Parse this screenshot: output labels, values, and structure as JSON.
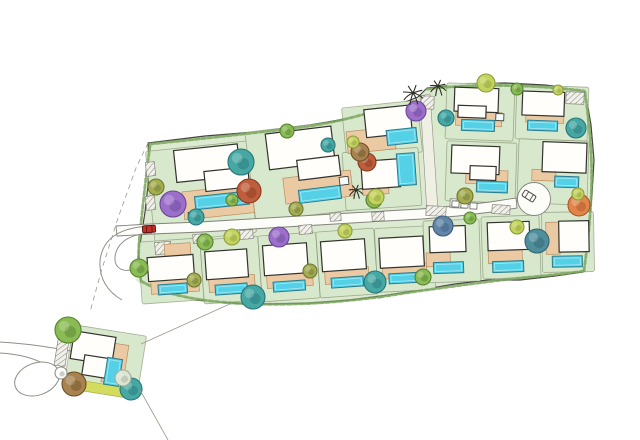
{
  "document": {
    "kind": "hand-drawn watercolor residential site masterplan",
    "canvas": {
      "width": 640,
      "height": 440
    },
    "visible_text": []
  },
  "palette": {
    "ink": "#45453c",
    "lawn": "#dcead2",
    "lawn_edge": "rgba(100,110,75,0.5)",
    "road_fill": "#fcfcf9",
    "road_stroke": "#82827a",
    "hedge": "#7aa55e",
    "hatch_line": "#8b8b81",
    "roles": {
      "house": {
        "f": "#fffefb",
        "s": "#33332d",
        "w": 1.2
      },
      "terrace": {
        "f": "#ebc9a3",
        "s": "#b98e60",
        "w": 0.7
      },
      "pool": {
        "f": "#55d1e7",
        "s": "#2a7d8e",
        "w": 1
      },
      "spa": {
        "f": "#f4fbfd",
        "s": "#33332d",
        "w": 0.8
      },
      "strip": {
        "f": "#d3dc5f",
        "s": "#a8b23c",
        "w": 0.6
      }
    },
    "trees": {
      "apple": {
        "f": "#8abb54",
        "s": "#55832f"
      },
      "lime": {
        "f": "#c3d35f",
        "s": "#8d9c39"
      },
      "teal": {
        "f": "#47a8a3",
        "s": "#26767c"
      },
      "slate": {
        "f": "#4f8e9b",
        "s": "#2f6470"
      },
      "slateblue": {
        "f": "#6286a8",
        "s": "#3d5f80"
      },
      "purple": {
        "f": "#9c6fca",
        "s": "#6c4899"
      },
      "brick": {
        "f": "#bf5e3d",
        "s": "#86391f"
      },
      "orange": {
        "f": "#e28449",
        "s": "#a85526"
      },
      "olive": {
        "f": "#a5ad52",
        "s": "#6f7630"
      },
      "olivebrown": {
        "f": "#a8834f",
        "s": "#6d5026"
      },
      "pale": {
        "f": "#dce4d4",
        "s": "#9fae94"
      },
      "whiteo": {
        "f": "#ffffff",
        "s": "#8f8f85"
      }
    }
  },
  "site": {
    "cluster_outline": [
      [
        148,
        143
      ],
      [
        205,
        136
      ],
      [
        255,
        132
      ],
      [
        310,
        125
      ],
      [
        345,
        119
      ],
      [
        372,
        111
      ],
      [
        400,
        104
      ],
      [
        418,
        97
      ],
      [
        427,
        88
      ],
      [
        465,
        84
      ],
      [
        505,
        83
      ],
      [
        545,
        85
      ],
      [
        585,
        90
      ],
      [
        591,
        125
      ],
      [
        594,
        160
      ],
      [
        592,
        195
      ],
      [
        589,
        225
      ],
      [
        585,
        255
      ],
      [
        583,
        272
      ],
      [
        555,
        276
      ],
      [
        520,
        280
      ],
      [
        488,
        280
      ],
      [
        455,
        284
      ],
      [
        420,
        290
      ],
      [
        388,
        295
      ],
      [
        350,
        300
      ],
      [
        310,
        303
      ],
      [
        270,
        304
      ],
      [
        230,
        303
      ],
      [
        195,
        300
      ],
      [
        163,
        292
      ],
      [
        141,
        281
      ],
      [
        138,
        258
      ],
      [
        141,
        238
      ],
      [
        145,
        212
      ],
      [
        148,
        185
      ],
      [
        149,
        163
      ]
    ],
    "lawn_patches": [
      [
        200,
        195,
        48,
        30,
        "#cde3bd",
        0
      ],
      [
        300,
        190,
        45,
        28,
        "#d3e7c4",
        0
      ],
      [
        480,
        112,
        62,
        30,
        "#d6e9c8",
        0
      ],
      [
        505,
        170,
        55,
        30,
        "#d0e5c2",
        0
      ],
      [
        300,
        272,
        165,
        26,
        "#d2e6c3",
        -2
      ],
      [
        120,
        365,
        18,
        26,
        "#cfe3b8",
        9
      ]
    ],
    "hedges": [
      "M150,144 C200,139 255,133 310,126 C335,122 355,117 372,112",
      "M150,146 C146,175 143,205 140,232 C138,252 138,268 141,280",
      "M141,281 C165,295 200,302 250,304 C300,305 330,303 380,297",
      "M380,297 C430,289 470,284 510,279 C540,276 565,274 584,271",
      "M585,92 C590,130 593,160 591,200 C589,235 586,255 584,271",
      "M427,89 C470,84 530,84 584,91",
      "M160,232 C200,228 240,224 300,221"
    ],
    "roads": {
      "main": "M116,226 L150,224 L200,222 L250,219 L300,216 L350,213 L385,211 L420,209 L455,206 L490,202 L516,198 L517,208 L492,212 L458,216 L422,219 L386,221 L352,223 L302,226 L252,229 L202,232 L152,234 L117,236 Z",
      "entrance": "M420,96 L430,94 L438,210 L427,213 Z",
      "culdesac": {
        "cx": 534,
        "cy": 199,
        "r": 16.5
      },
      "sw_access": [
        "M152,226 C116,227 102,241 100,261 C99,279 108,292 122,300",
        "M152,233 C125,234 116,246 115,257 C114,268 123,273 134,269"
      ],
      "west_road": [
        "M0,342 C35,344 76,351 114,361",
        "M0,353 C18,354 34,358 46,365"
      ],
      "west_bulb": {
        "cx": 37,
        "cy": 379,
        "rx": 23,
        "ry": 16,
        "rot": -20
      }
    },
    "lots": [
      {
        "id": "top-1",
        "rot": -6,
        "lawn": [
          150,
          146,
          102,
          92
        ],
        "parts": [
          [
            "house",
            178,
            148,
            64,
            32
          ],
          [
            "house",
            206,
            172,
            44,
            20
          ],
          [
            "terrace",
            182,
            190,
            70,
            28
          ],
          [
            "pool",
            194,
            196,
            54,
            13
          ],
          [
            "spa",
            186,
            211,
            11,
            8
          ]
        ]
      },
      {
        "id": "top-2",
        "rot": -7,
        "lawn": [
          250,
          126,
          102,
          90
        ],
        "parts": [
          [
            "house",
            270,
            130,
            66,
            36
          ],
          [
            "house",
            298,
            160,
            42,
            20
          ],
          [
            "terrace",
            282,
            176,
            68,
            26
          ],
          [
            "pool",
            296,
            190,
            42,
            13
          ],
          [
            "spa",
            338,
            182,
            9,
            8
          ]
        ]
      },
      {
        "id": "mid-upper",
        "rot": -6,
        "lawn": [
          344,
          104,
          76,
          52
        ],
        "parts": [
          [
            "house",
            366,
            108,
            46,
            28
          ],
          [
            "terrace",
            346,
            128,
            48,
            22
          ],
          [
            "pool",
            386,
            131,
            30,
            15
          ]
        ]
      },
      {
        "id": "mid-lower",
        "rot": -4,
        "lawn": [
          344,
          150,
          76,
          58
        ],
        "parts": [
          [
            "house",
            362,
            160,
            38,
            28
          ],
          [
            "pool",
            398,
            155,
            18,
            32
          ],
          [
            "terrace",
            362,
            184,
            26,
            10
          ]
        ]
      },
      {
        "id": "ne-row1-a",
        "rot": 2,
        "lawn": [
          446,
          84,
          68,
          56
        ],
        "parts": [
          [
            "house",
            454,
            88,
            44,
            24
          ],
          [
            "house",
            458,
            106,
            28,
            12
          ],
          [
            "terrace",
            456,
            112,
            46,
            14
          ],
          [
            "pool",
            462,
            120,
            33,
            11
          ],
          [
            "spa",
            496,
            113,
            8,
            7
          ]
        ]
      },
      {
        "id": "ne-row1-b",
        "rot": 2,
        "lawn": [
          516,
          86,
          72,
          54
        ],
        "parts": [
          [
            "house",
            522,
            92,
            42,
            24
          ],
          [
            "terrace",
            526,
            110,
            38,
            13
          ],
          [
            "pool",
            528,
            121,
            30,
            10
          ]
        ]
      },
      {
        "id": "ne-row2-a",
        "rot": 2,
        "lawn": [
          446,
          142,
          70,
          60
        ],
        "parts": [
          [
            "house",
            451,
            146,
            48,
            28
          ],
          [
            "house",
            470,
            166,
            26,
            14
          ],
          [
            "terrace",
            466,
            170,
            42,
            14
          ],
          [
            "pool",
            477,
            181,
            31,
            11
          ]
        ]
      },
      {
        "id": "ne-row2-b",
        "rot": 2,
        "lawn": [
          518,
          140,
          70,
          64
        ],
        "parts": [
          [
            "house",
            542,
            142,
            44,
            30
          ],
          [
            "terrace",
            532,
            170,
            24,
            11
          ],
          [
            "pool",
            555,
            176,
            24,
            11
          ]
        ]
      },
      {
        "id": "south-1",
        "rot": -4,
        "lawn": [
          140,
          240,
          62,
          62
        ],
        "parts": [
          [
            "terrace",
            166,
            244,
            26,
            16
          ],
          [
            "house",
            148,
            256,
            46,
            24
          ],
          [
            "terrace",
            150,
            276,
            48,
            17
          ],
          [
            "pool",
            157,
            284,
            29,
            10
          ]
        ]
      },
      {
        "id": "south-2",
        "rot": -4,
        "lawn": [
          202,
          238,
          58,
          64
        ],
        "parts": [
          [
            "house",
            206,
            250,
            42,
            28
          ],
          [
            "terrace",
            208,
            276,
            46,
            15
          ],
          [
            "pool",
            214,
            284,
            32,
            10
          ]
        ]
      },
      {
        "id": "south-3",
        "rot": -4,
        "lawn": [
          260,
          234,
          58,
          66
        ],
        "parts": [
          [
            "house",
            264,
            244,
            44,
            30
          ],
          [
            "terrace",
            266,
            272,
            46,
            15
          ],
          [
            "pool",
            272,
            281,
            32,
            10
          ]
        ]
      },
      {
        "id": "south-4",
        "rot": -4,
        "lawn": [
          318,
          230,
          58,
          66
        ],
        "parts": [
          [
            "house",
            322,
            240,
            44,
            30
          ],
          [
            "terrace",
            324,
            268,
            44,
            15
          ],
          [
            "pool",
            330,
            277,
            32,
            10
          ]
        ]
      },
      {
        "id": "south-5",
        "rot": -3,
        "lawn": [
          376,
          227,
          58,
          64
        ],
        "parts": [
          [
            "house",
            380,
            237,
            44,
            30
          ],
          [
            "terrace",
            382,
            264,
            44,
            14
          ],
          [
            "pool",
            388,
            273,
            32,
            10
          ]
        ]
      },
      {
        "id": "south-6",
        "rot": -2,
        "lawn": [
          424,
          220,
          56,
          62
        ],
        "parts": [
          [
            "house",
            430,
            226,
            36,
            26
          ],
          [
            "terrace",
            426,
            252,
            24,
            14
          ],
          [
            "pool",
            433,
            262,
            30,
            11
          ]
        ]
      },
      {
        "id": "south-7",
        "rot": -2,
        "lawn": [
          482,
          216,
          58,
          62
        ],
        "parts": [
          [
            "house",
            488,
            222,
            42,
            28
          ],
          [
            "terrace",
            488,
            250,
            34,
            13
          ],
          [
            "pool",
            492,
            261,
            31,
            11
          ]
        ]
      },
      {
        "id": "south-8",
        "rot": -1,
        "lawn": [
          542,
          212,
          52,
          60
        ],
        "parts": [
          [
            "terrace",
            546,
            222,
            14,
            32
          ],
          [
            "house",
            559,
            221,
            30,
            31
          ],
          [
            "pool",
            552,
            256,
            30,
            11
          ]
        ]
      },
      {
        "id": "detached-sw",
        "rot": 9,
        "lawn": [
          68,
          330,
          74,
          64
        ],
        "parts": [
          [
            "house",
            70,
            336,
            42,
            28
          ],
          [
            "house",
            84,
            358,
            24,
            20
          ],
          [
            "terrace",
            104,
            342,
            22,
            40
          ],
          [
            "pool",
            107,
            357,
            15,
            27
          ],
          [
            "strip",
            78,
            384,
            58,
            10
          ]
        ]
      }
    ],
    "trees": [
      [
        241,
        162,
        13,
        "teal"
      ],
      [
        196,
        217,
        8,
        "teal"
      ],
      [
        328,
        145,
        7,
        "teal"
      ],
      [
        446,
        118,
        8,
        "teal"
      ],
      [
        576,
        128,
        10,
        "teal"
      ],
      [
        253,
        297,
        12,
        "teal"
      ],
      [
        375,
        282,
        11,
        "teal"
      ],
      [
        131,
        389,
        11,
        "teal"
      ],
      [
        537,
        241,
        12,
        "slate"
      ],
      [
        443,
        226,
        10,
        "slateblue"
      ],
      [
        173,
        204,
        13,
        "purple"
      ],
      [
        416,
        111,
        10,
        "purple"
      ],
      [
        279,
        237,
        10,
        "purple"
      ],
      [
        249,
        191,
        12,
        "brick"
      ],
      [
        367,
        162,
        9,
        "brick"
      ],
      [
        360,
        152,
        9,
        "olivebrown"
      ],
      [
        74,
        384,
        12,
        "olivebrown"
      ],
      [
        579,
        205,
        11,
        "orange"
      ],
      [
        232,
        200,
        6,
        "apple"
      ],
      [
        287,
        131,
        7,
        "apple"
      ],
      [
        374,
        200,
        8,
        "apple"
      ],
      [
        470,
        218,
        6,
        "apple"
      ],
      [
        139,
        268,
        9,
        "apple"
      ],
      [
        205,
        242,
        8,
        "apple"
      ],
      [
        68,
        330,
        13,
        "apple"
      ],
      [
        423,
        277,
        8,
        "apple"
      ],
      [
        517,
        89,
        6,
        "apple"
      ],
      [
        353,
        142,
        6,
        "lime"
      ],
      [
        486,
        83,
        9,
        "lime"
      ],
      [
        578,
        194,
        6,
        "lime"
      ],
      [
        517,
        227,
        7,
        "lime"
      ],
      [
        232,
        237,
        8,
        "lime"
      ],
      [
        345,
        231,
        7,
        "lime"
      ],
      [
        376,
        197,
        8,
        "lime"
      ],
      [
        558,
        90,
        5,
        "lime"
      ],
      [
        156,
        187,
        8,
        "olive"
      ],
      [
        296,
        209,
        7,
        "olive"
      ],
      [
        194,
        280,
        7,
        "olive"
      ],
      [
        310,
        271,
        7,
        "olive"
      ],
      [
        465,
        196,
        8,
        "olive"
      ],
      [
        123,
        378,
        8,
        "pale"
      ],
      [
        61,
        373,
        6,
        "whiteo"
      ]
    ],
    "palms": [
      [
        413,
        93,
        10
      ],
      [
        438,
        86,
        8
      ],
      [
        356,
        190,
        7
      ]
    ],
    "cars": [
      {
        "x": 149,
        "y": 229,
        "rot": -3,
        "fill": "#c62f26",
        "stroke": "#571410"
      },
      {
        "x": 529,
        "y": 196,
        "rot": 32,
        "fill": "#fafaf5",
        "stroke": "#45453c"
      }
    ],
    "hatches": [
      [
        155,
        242,
        16,
        12,
        -4
      ],
      [
        193,
        234,
        14,
        9,
        -4
      ],
      [
        240,
        230,
        13,
        9,
        -4
      ],
      [
        299,
        225,
        13,
        9,
        -4
      ],
      [
        330,
        213,
        11,
        8,
        -3
      ],
      [
        372,
        212,
        12,
        9,
        -3
      ],
      [
        426,
        206,
        20,
        10,
        2
      ],
      [
        450,
        199,
        16,
        9,
        2
      ],
      [
        492,
        205,
        18,
        9,
        3
      ],
      [
        421,
        96,
        13,
        13,
        2
      ],
      [
        566,
        92,
        18,
        12,
        2
      ],
      [
        146,
        162,
        9,
        14,
        -6
      ],
      [
        146,
        196,
        9,
        14,
        -6
      ],
      [
        56,
        340,
        11,
        26,
        9
      ]
    ],
    "parking": [
      [
        452,
        201
      ],
      [
        461,
        202
      ],
      [
        470,
        203
      ]
    ],
    "lines": [
      {
        "d": "M148,143 L136,168 L118,218 L101,272 L90,312",
        "dash": "5,4"
      },
      {
        "d": "M232,303 L141,344",
        "dash": ""
      },
      {
        "d": "M140,390 L168,440",
        "dash": ""
      }
    ]
  }
}
